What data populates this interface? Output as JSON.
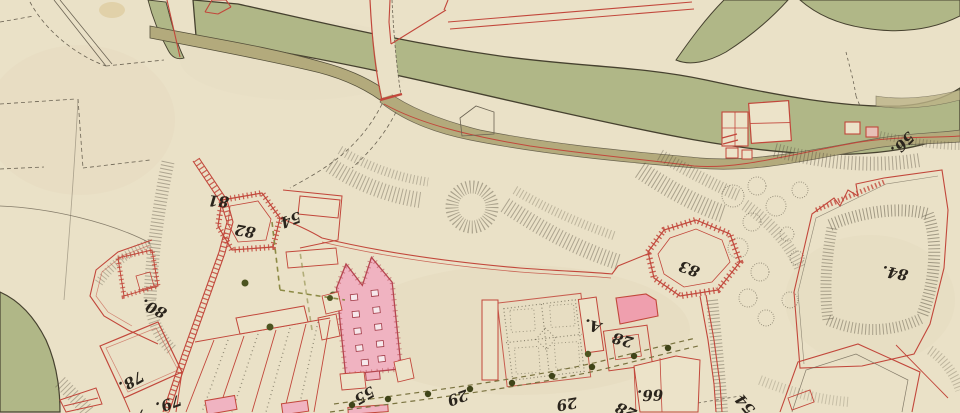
{
  "map": {
    "kind": "hand-drawn fortification plan",
    "colors": {
      "parchment": "#eae1c7",
      "river_green": "#b0b787",
      "channel_olive": "#b3aa7c",
      "ink": "#46412f",
      "red_ink": "#c2473b",
      "building_pink": "#f0b3c1",
      "path_olive": "#8c8a45",
      "tree_green": "#4c5420"
    },
    "labels": [
      {
        "name": "parcel-81",
        "text": "81"
      },
      {
        "name": "parcel-82",
        "text": "82"
      },
      {
        "name": "parcel-54-upper",
        "text": "54"
      },
      {
        "name": "parcel-80",
        "text": "80."
      },
      {
        "name": "parcel-78",
        "text": "78."
      },
      {
        "name": "parcel-79",
        "text": "79."
      },
      {
        "name": "parcel-partial-7",
        "text": "7"
      },
      {
        "name": "parcel-55",
        "text": "55"
      },
      {
        "name": "parcel-29-west",
        "text": "29"
      },
      {
        "name": "parcel-29-east",
        "text": "29"
      },
      {
        "name": "parcel-a",
        "text": "A."
      },
      {
        "name": "parcel-28-upper",
        "text": "28"
      },
      {
        "name": "parcel-66",
        "text": "66."
      },
      {
        "name": "parcel-28-lower",
        "text": "28"
      },
      {
        "name": "parcel-54-lower",
        "text": "54"
      },
      {
        "name": "bastion-83",
        "text": "83"
      },
      {
        "name": "outwork-84",
        "text": "84."
      },
      {
        "name": "parcel-56",
        "text": "56."
      }
    ]
  }
}
